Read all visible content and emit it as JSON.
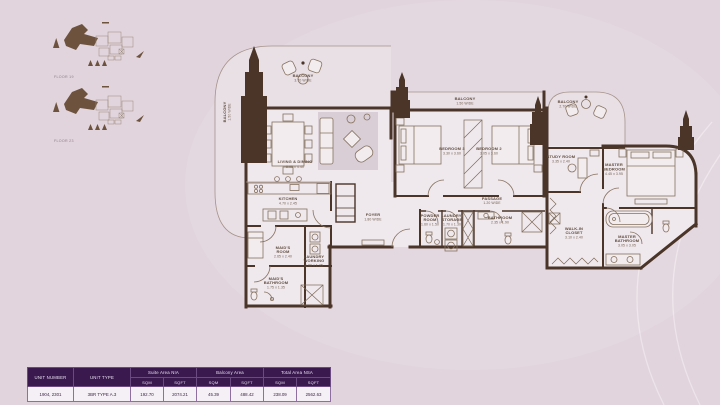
{
  "colors": {
    "background": "#e1d4dd",
    "wall_brown": "#4a3528",
    "highlight_brown": "#6d523d",
    "table_header_purple": "#39194e",
    "table_row_bg": "#f5f0f5"
  },
  "key_plans": [
    {
      "label": "FLOOR 19"
    },
    {
      "label": "FLOOR 23"
    }
  ],
  "plan": {
    "rooms": [
      {
        "id": "balcony-top-left",
        "lines": [
          "BALCONY",
          "3.70 WIDE"
        ]
      },
      {
        "id": "balcony-left",
        "lines": [
          "BALCONY",
          "1.50 WIDE"
        ]
      },
      {
        "id": "living-dining",
        "lines": [
          "LIVING & DINING",
          "8.05 x 4.40"
        ]
      },
      {
        "id": "kitchen",
        "lines": [
          "KITCHEN",
          "4.70 x 2.45"
        ]
      },
      {
        "id": "balcony-middle",
        "lines": [
          "BALCONY",
          "1.50 WIDE"
        ]
      },
      {
        "id": "bedroom-3",
        "lines": [
          "BEDROOM 3",
          "3.30 x 3.60"
        ]
      },
      {
        "id": "bedroom-2",
        "lines": [
          "BEDROOM 2",
          "3.05 x 3.60"
        ]
      },
      {
        "id": "balcony-right",
        "lines": [
          "BALCONY",
          "2.70 WIDE"
        ]
      },
      {
        "id": "study-room",
        "lines": [
          "STUDY ROOM",
          "3.35 x 2.40"
        ]
      },
      {
        "id": "master-bedroom",
        "lines": [
          "MASTER",
          "BEDROOM",
          "4.45 x 3.95"
        ]
      },
      {
        "id": "passage",
        "lines": [
          "PASSAGE",
          "1.20 WIDE"
        ]
      },
      {
        "id": "foyer",
        "lines": [
          "FOYER",
          "1.80 WIDE"
        ]
      },
      {
        "id": "powder-room",
        "lines": [
          "POWDER",
          "ROOM",
          "1.60 x 1.50"
        ]
      },
      {
        "id": "laundry-storage",
        "lines": [
          "LAUNDRY/",
          "STORAGE",
          "1.70 x 1.30"
        ]
      },
      {
        "id": "bathroom",
        "lines": [
          "BATHROOM",
          "2.35 x 1.90"
        ]
      },
      {
        "id": "maids-room",
        "lines": [
          "MAID'S",
          "ROOM",
          "2.65 x 2.40"
        ]
      },
      {
        "id": "laundry-working",
        "lines": [
          "LAUNDRY",
          "WORKING",
          "1.00 x 1.35"
        ]
      },
      {
        "id": "maids-bathroom",
        "lines": [
          "MAID'S",
          "BATHROOM",
          "1.75 x 1.35"
        ]
      },
      {
        "id": "walk-in-closet",
        "lines": [
          "WALK-IN",
          "CLOSET",
          "3.10 x 2.40"
        ]
      },
      {
        "id": "master-bathroom",
        "lines": [
          "MASTER",
          "BATHROOM",
          "3.05 x 3.05"
        ]
      }
    ]
  },
  "table": {
    "headers": {
      "unit_number": "UNIT NUMBER",
      "unit_type": "UNIT TYPE",
      "suite_area": "Suite Area NIA",
      "balcony_area": "Balcony Area",
      "total_area": "Total Area NSA",
      "sqm": "SQM",
      "sqft": "SQFT"
    },
    "row": {
      "unit_number": "1904, 2301",
      "unit_type": "3BR TYPE A.3",
      "suite_sqm": "192.70",
      "suite_sqft": "2074.21",
      "balcony_sqm": "45.39",
      "balcony_sqft": "488.42",
      "total_sqm": "238.09",
      "total_sqft": "2562.63"
    }
  }
}
